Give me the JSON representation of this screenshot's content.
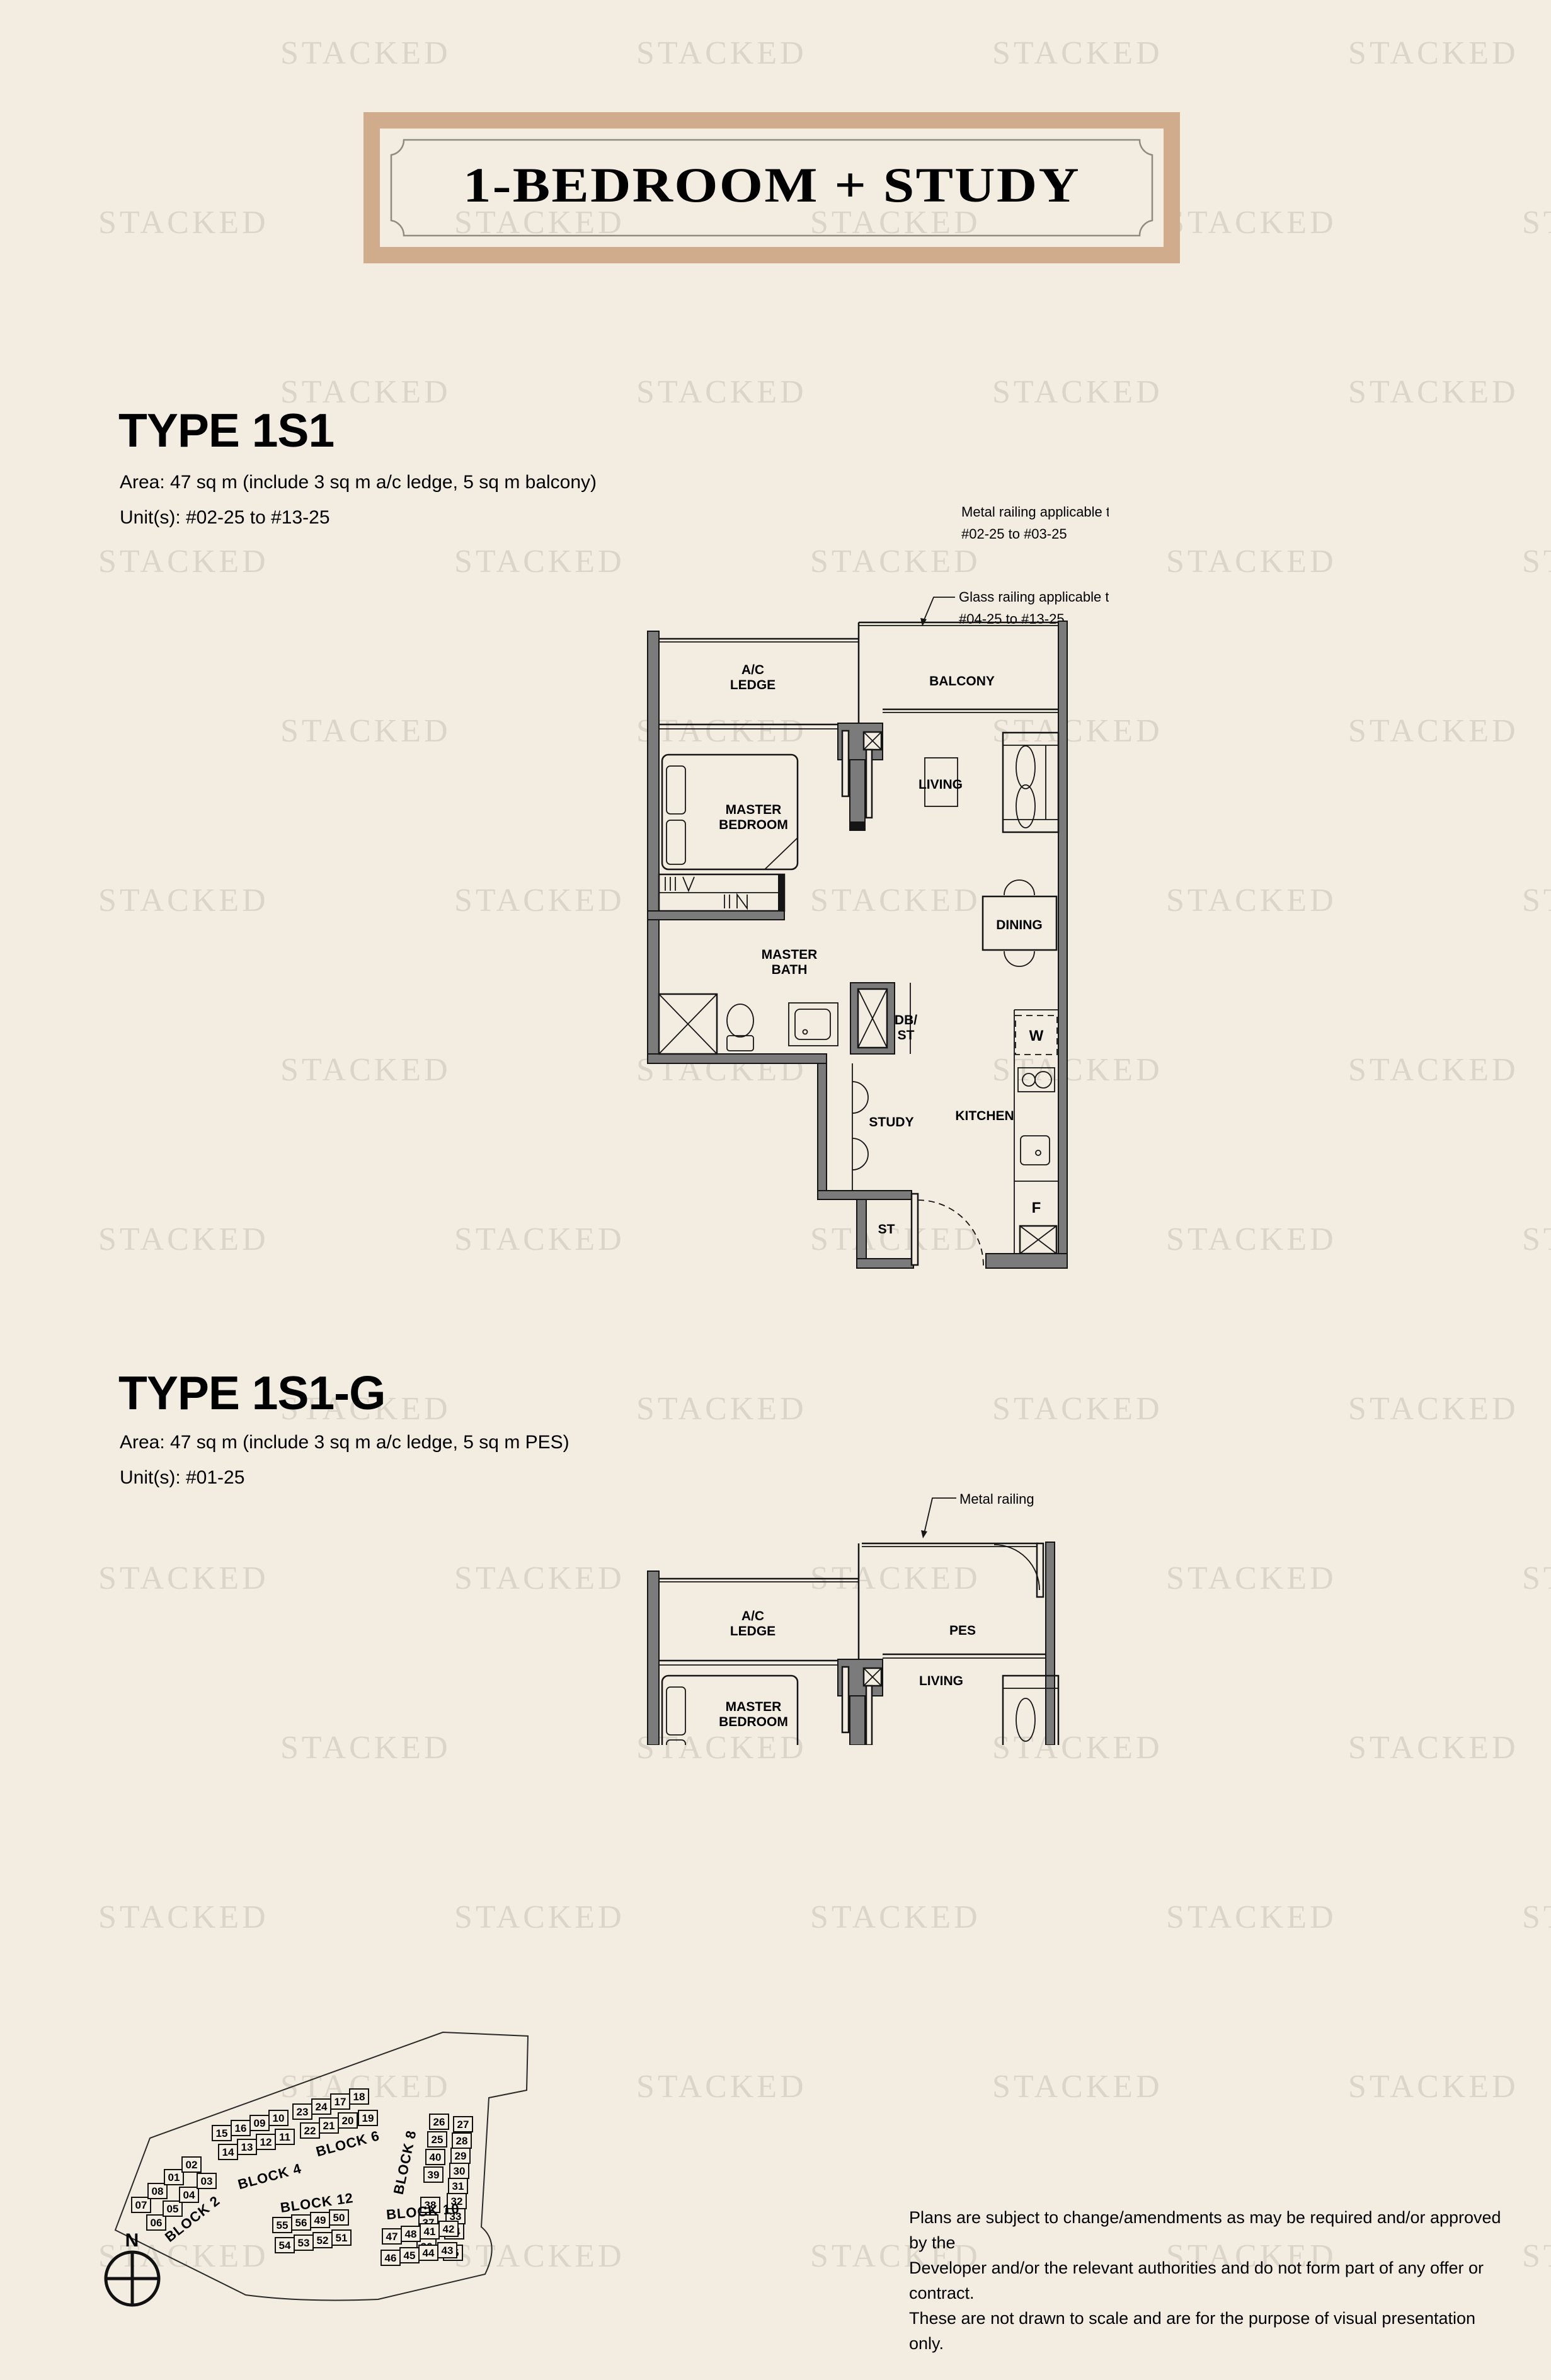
{
  "page": {
    "background_color": "#f2ece1",
    "watermark_text": "STACKED"
  },
  "banner": {
    "title": "1-BEDROOM + STUDY",
    "border_color": "#d0ab8c"
  },
  "type_1s1": {
    "heading": "TYPE 1S1",
    "area_line": "Area: 47 sq m (include 3 sq m a/c ledge, 5 sq m balcony)",
    "unit_line": "Unit(s): #02-25 to #13-25",
    "note_metal": "Metal railing applicable to|#02-25 to #03-25",
    "note_glass": "Glass railing applicable to|#04-25 to #13-25",
    "rooms": {
      "ac_ledge": "A/C|LEDGE",
      "balcony": "BALCONY",
      "master_bedroom": "MASTER|BEDROOM",
      "living": "LIVING",
      "dining": "DINING",
      "master_bath": "MASTER|BATH",
      "db_st": "DB/|ST",
      "study": "STUDY",
      "kitchen": "KITCHEN",
      "washer": "W",
      "fridge": "F",
      "store": "ST"
    }
  },
  "type_1s1g": {
    "heading": "TYPE 1S1-G",
    "area_line": "Area: 47 sq m (include 3 sq m a/c ledge, 5 sq m PES)",
    "unit_line": "Unit(s): #01-25",
    "note_metal": "Metal railing",
    "rooms": {
      "ac_ledge": "A/C|LEDGE",
      "pes": "PES",
      "master_bedroom": "MASTER|BEDROOM",
      "living": "LIVING"
    }
  },
  "site_plan": {
    "compass": "N",
    "highlight_unit": "25",
    "highlight_color": "#c8a284",
    "blocks": [
      {
        "name": "BLOCK 2",
        "rows": [
          [
            "07",
            "08",
            "01",
            "02"
          ],
          [
            "06",
            "05",
            "04",
            "03"
          ]
        ]
      },
      {
        "name": "BLOCK 4",
        "rows": [
          [
            "15",
            "16",
            "09",
            "10"
          ],
          [
            "14",
            "13",
            "12",
            "11"
          ]
        ]
      },
      {
        "name": "BLOCK 6",
        "rows": [
          [
            "23",
            "24",
            "17",
            "18"
          ],
          [
            "22",
            "21",
            "20",
            "19"
          ]
        ]
      },
      {
        "name": "BLOCK 8",
        "rows": [
          [
            "26",
            "25",
            "40",
            "39",
            "38",
            "37",
            "36"
          ],
          [
            "27",
            "28",
            "29",
            "30",
            "31",
            "32",
            "33",
            "34",
            "35"
          ]
        ]
      },
      {
        "name": "BLOCK 10",
        "rows": [
          [
            "47",
            "48",
            "41",
            "42"
          ],
          [
            "46",
            "45",
            "44",
            "43"
          ]
        ]
      },
      {
        "name": "BLOCK 12",
        "rows": [
          [
            "55",
            "56",
            "49",
            "50"
          ],
          [
            "54",
            "53",
            "52",
            "51"
          ]
        ]
      }
    ]
  },
  "disclaimer": {
    "lines": [
      "Plans are subject to change/amendments as may be required and/or approved by the",
      "Developer and/or the relevant authorities and do not form part of any offer or contract.",
      "These are not drawn to scale and are for the purpose of visual presentation only."
    ]
  }
}
